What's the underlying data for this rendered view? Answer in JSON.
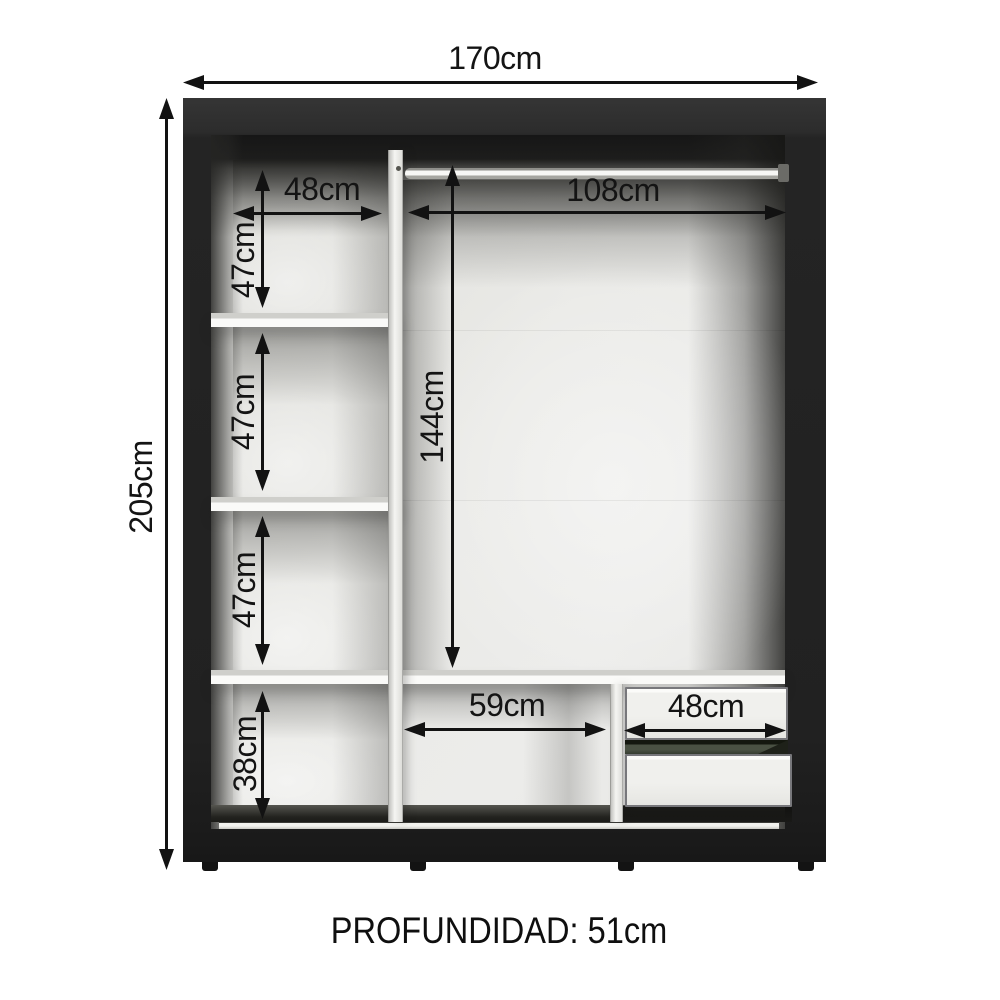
{
  "diagram": {
    "kind": "wardrobe interior dimension diagram",
    "caption": "PROFUNDIDAD: 51cm",
    "dims": {
      "overall_width": "170cm",
      "overall_height": "205cm",
      "upper_shelf_width": "48cm",
      "rod_width": "108cm",
      "shelf_section_1": "47cm",
      "shelf_section_2": "47cm",
      "shelf_section_3": "47cm",
      "bottom_left_height": "38cm",
      "hanging_height": "144cm",
      "bottom_open_width": "59cm",
      "drawer_width": "48cm"
    },
    "colors": {
      "frame": "#242424",
      "interior_back": "#e9e9e6",
      "shelf": "#fafaf8",
      "dimension_line": "#121212",
      "drawer_gap": "#4a5143",
      "background": "#ffffff"
    }
  }
}
